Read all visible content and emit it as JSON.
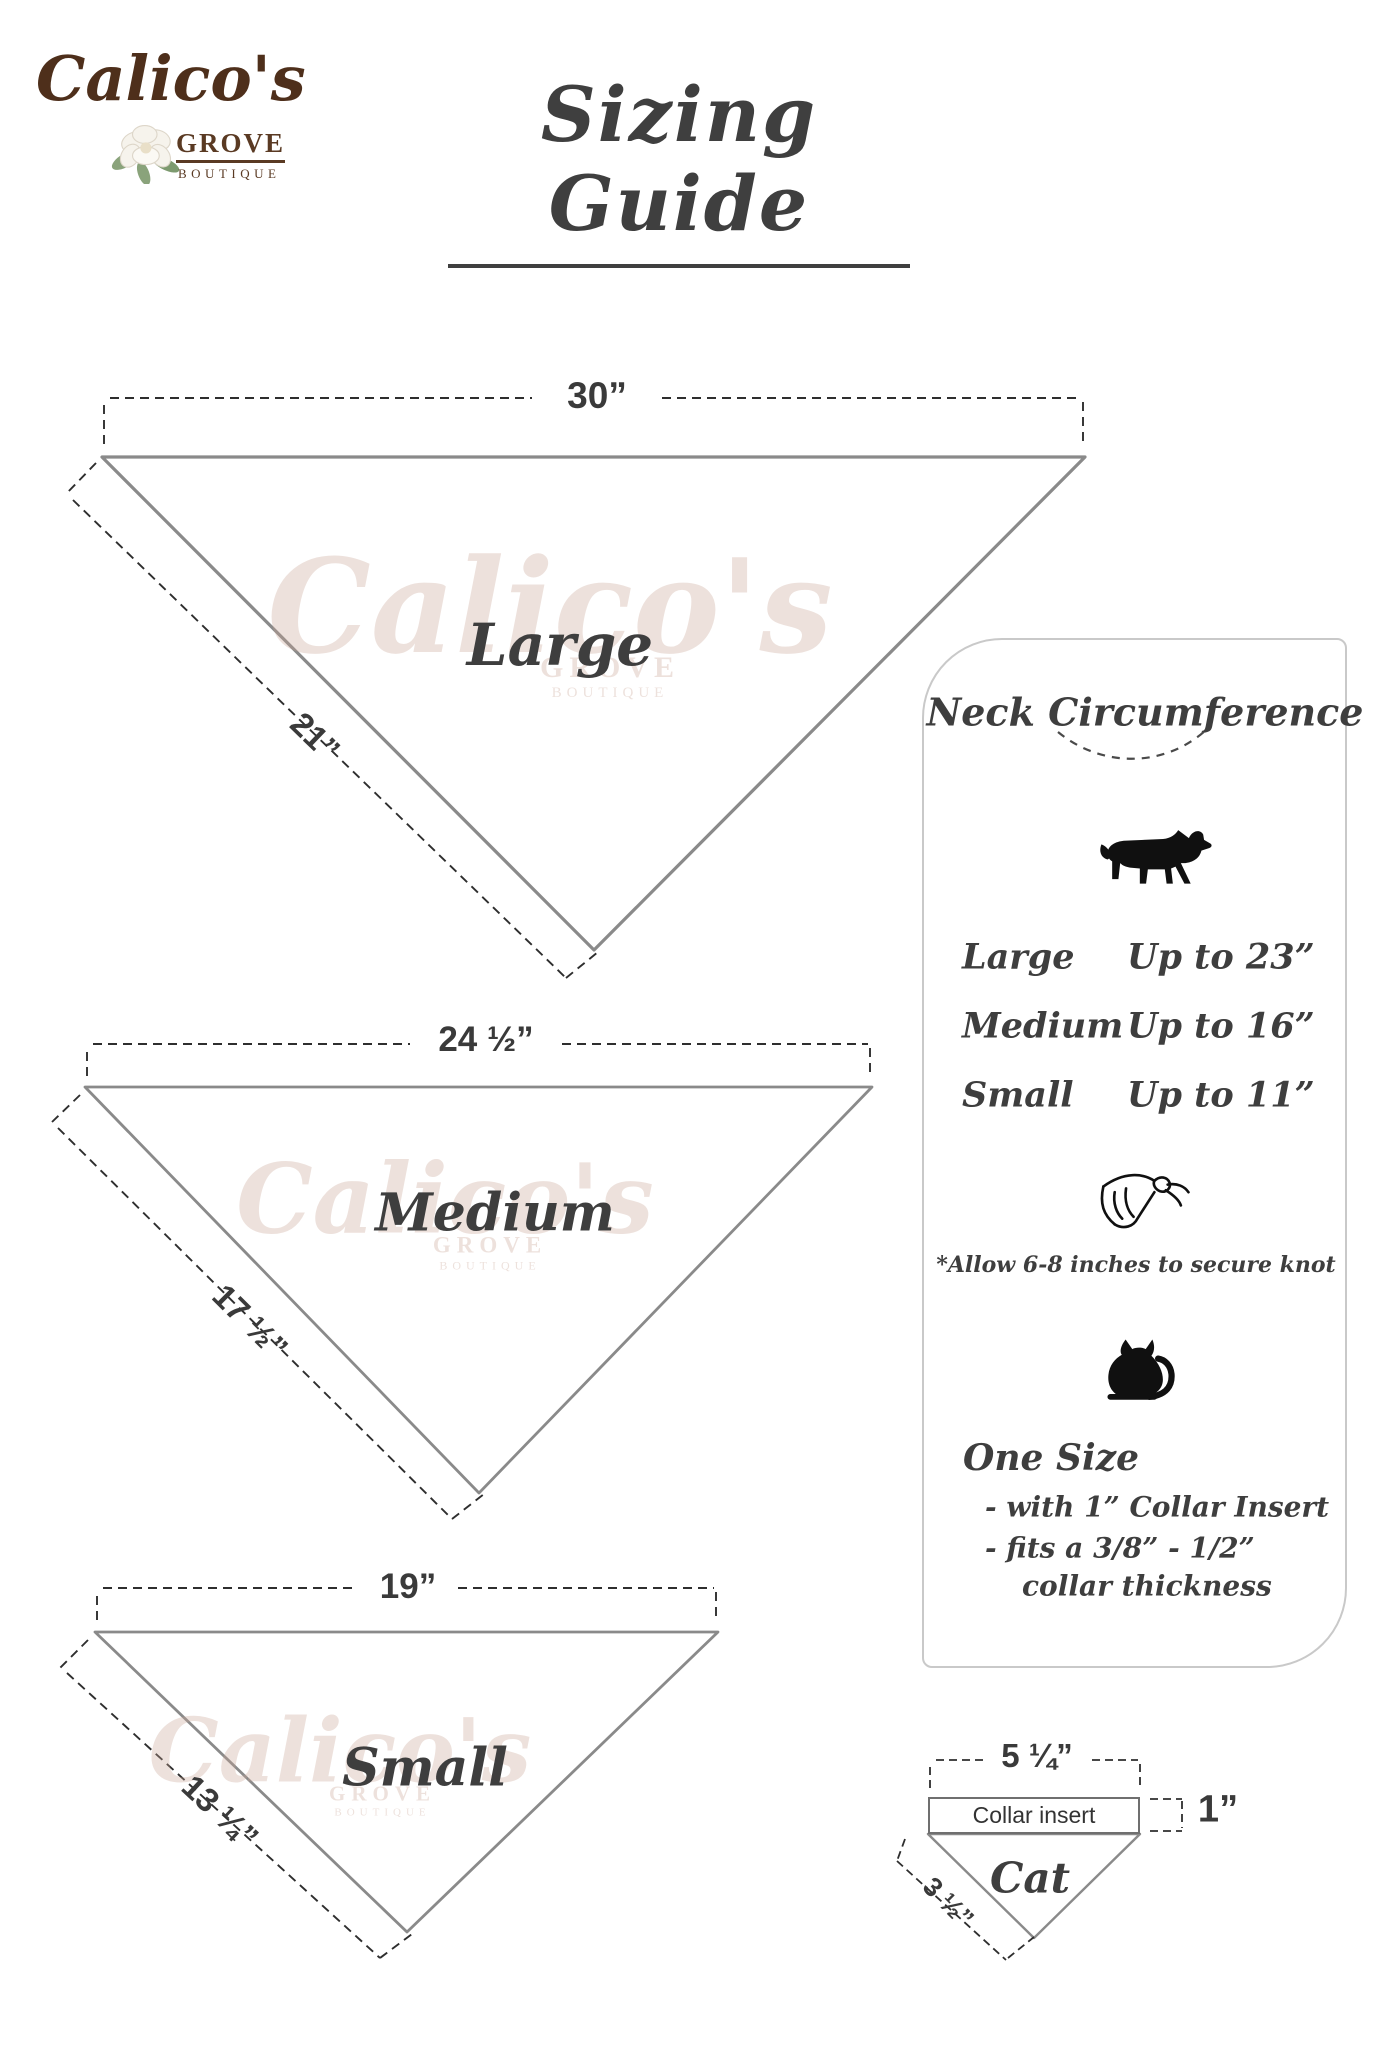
{
  "logo": {
    "name": "Calico's",
    "grove": "GROVE",
    "boutique": "BOUTIQUE"
  },
  "title": "Sizing Guide",
  "watermark": {
    "name": "Calico's",
    "grove": "GROVE",
    "boutique": "BOUTIQUE"
  },
  "triangles": {
    "large": {
      "label": "Large",
      "top_width": "30”",
      "side_length": "21”"
    },
    "medium": {
      "label": "Medium",
      "top_width": "24 ½”",
      "side_length": "17 ½”"
    },
    "small": {
      "label": "Small",
      "top_width": "19”",
      "side_length": "13 ¼”"
    }
  },
  "panel": {
    "title": "Neck Circumference",
    "rows": [
      {
        "size": "Large",
        "value": "Up to 23”"
      },
      {
        "size": "Medium",
        "value": "Up to 16”"
      },
      {
        "size": "Small",
        "value": "Up to 11”"
      }
    ],
    "knot_note": "*Allow 6-8 inches to secure knot",
    "one_size": {
      "heading": "One Size",
      "line1": "- with 1” Collar Insert",
      "line2": "- fits a 3/8” - 1/2”",
      "line3": "collar thickness"
    }
  },
  "cat_diagram": {
    "label": "Cat",
    "top_width": "5 ¼”",
    "insert_label": "Collar insert",
    "insert_height": "1”",
    "side_length": "3 ½”"
  },
  "colors": {
    "triangle_stroke": "#8a8a8a",
    "dash_stroke": "#2e2e2e",
    "text": "#3c3c3c",
    "brand_brown": "#4e2f1b",
    "panel_border": "#c9c9c9"
  }
}
